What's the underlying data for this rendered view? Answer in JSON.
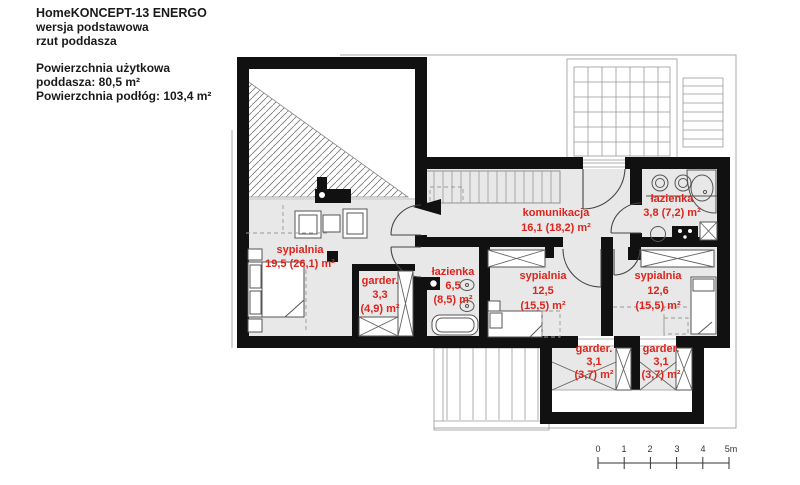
{
  "header": {
    "title": "HomeKONCEPT-13 ENERGO",
    "subtitle1": "wersja podstawowa",
    "subtitle2": "rzut poddasza",
    "area_label": "Powierzchnia użytkowa",
    "area_value": "poddasza: 80,5 m²",
    "floor_area": "Powierzchnia podłóg: 103,4 m²"
  },
  "rooms": [
    {
      "name": "sypialnia",
      "lines": [
        "sypialnia",
        "19,5 (26,1) m²"
      ]
    },
    {
      "name": "garderoba",
      "lines": [
        "garder.",
        "3,3",
        "(4,9) m²"
      ]
    },
    {
      "name": "lazienka",
      "lines": [
        "łazienka",
        "6,5",
        "(8,5) m²"
      ]
    },
    {
      "name": "komunikacja",
      "lines": [
        "komunikacja",
        "16,1 (18,2) m²"
      ]
    },
    {
      "name": "lazienka-2",
      "lines": [
        "łazienka",
        "3,8 (7,2) m²"
      ]
    },
    {
      "name": "sypialnia-2",
      "lines": [
        "sypialnia",
        "12,5",
        "(15,5) m²"
      ]
    },
    {
      "name": "sypialnia-3",
      "lines": [
        "sypialnia",
        "12,6",
        "(15,5) m²"
      ]
    },
    {
      "name": "garderoba-2",
      "lines": [
        "garder.",
        "3,1",
        "(3,7) m²"
      ]
    },
    {
      "name": "garderoba-3",
      "lines": [
        "garder.",
        "3,1",
        "(3,7) m²"
      ]
    }
  ],
  "scale_bar": {
    "ticks": [
      "0",
      "1",
      "2",
      "3",
      "4",
      "5m"
    ]
  },
  "colors": {
    "label_red": "#de241c",
    "floor_gray": "#e8e8e8",
    "wall_black": "#111111"
  }
}
